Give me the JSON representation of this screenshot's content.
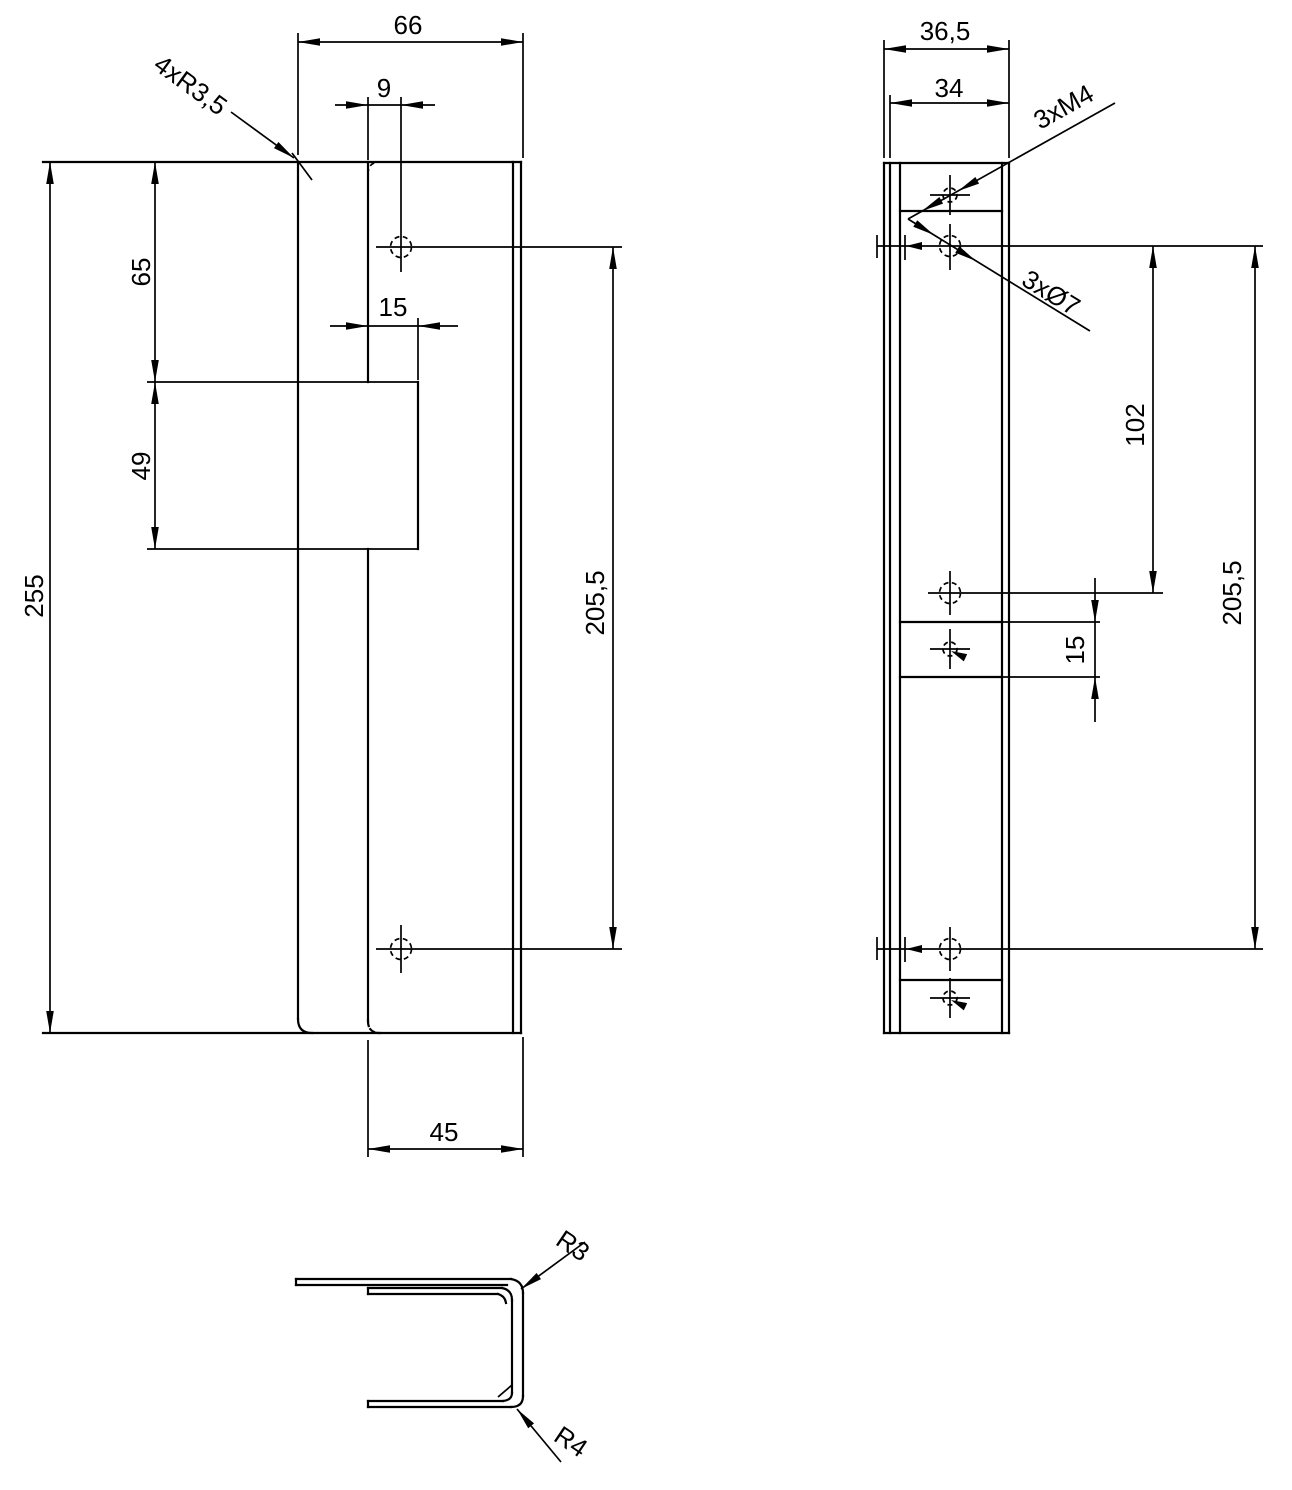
{
  "drawing": {
    "front_view": {
      "total_width": "66",
      "hole_offset": "9",
      "notch_depth": "15",
      "top_section_height": "65",
      "notch_height": "49",
      "total_height": "255",
      "hole_spacing": "205,5",
      "bottom_width": "45",
      "corner_radius_note": "4xR3,5"
    },
    "side_view": {
      "outer_depth": "36,5",
      "inner_depth": "34",
      "tapped_holes_note": "3xM4",
      "through_holes_note": "3xØ7",
      "upper_hole_spacing": "102",
      "slot_height": "15",
      "hole_spacing": "205,5"
    },
    "section_view": {
      "top_bend_radius": "R3",
      "bottom_bend_radius": "R4"
    }
  }
}
